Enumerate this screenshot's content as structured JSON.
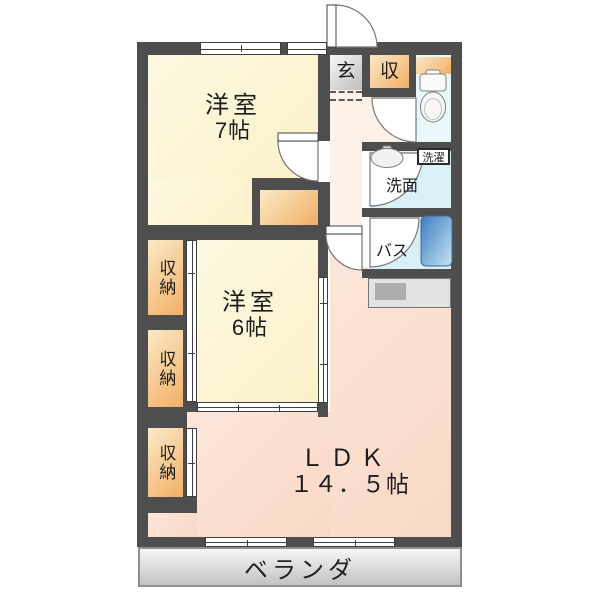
{
  "plan": {
    "rooms": {
      "western7": {
        "name": "洋室",
        "size": "7帖"
      },
      "western6": {
        "name": "洋室",
        "size": "6帖"
      },
      "ldk": {
        "name": "ＬＤＫ",
        "size": "１４．５帖"
      }
    },
    "storage": {
      "closet1": "収納",
      "closet2": "収納",
      "closet3": "収納",
      "entry_storage": "収"
    },
    "entry": {
      "genkan": "玄"
    },
    "sanitary": {
      "laundry": "洗濯",
      "washroom": "洗面",
      "bath": "バス"
    },
    "balcony": {
      "label": "ベランダ"
    },
    "colors": {
      "wall": "#4e4e4e",
      "room_floor": "#fbf0c8",
      "ldk_floor": "#f9d8c6",
      "hall_floor": "#fcf1e8",
      "storage": "#f1af66",
      "wet_area": "#daf1f7",
      "bathtub": "#3f7cbf",
      "veranda": "#d9d9d9"
    }
  }
}
